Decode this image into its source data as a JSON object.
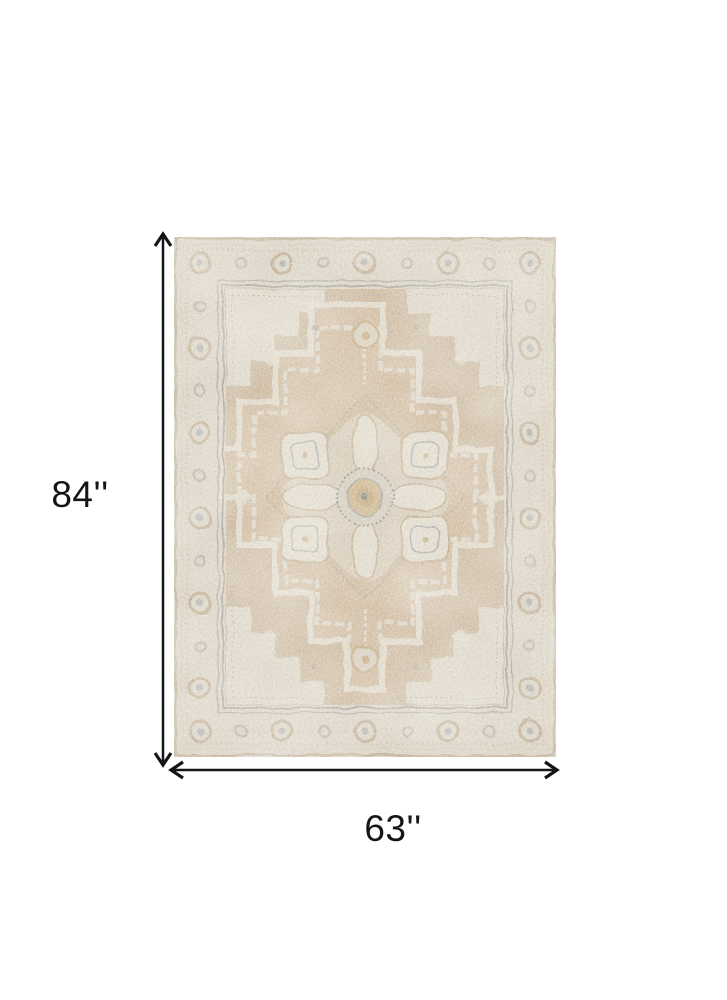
{
  "page": {
    "background_color": "#ffffff",
    "type": "product-dimension-diagram"
  },
  "product": {
    "description": "Distressed beige and tan traditional oriental area rug with large center medallion, ornate floral border and cream corner spandrels",
    "colors": {
      "border_band": "#d8d0c1",
      "field": "#c3a988",
      "medallion": "#c9ad8a",
      "motif_cream": "#e2dbcb",
      "spandrel": "#dcd5c5",
      "accent_gray": "#8d9295",
      "accent_gold": "#bb9a66",
      "frame_gray": "#93928b",
      "edge_tan": "#b5a084"
    }
  },
  "annotations": {
    "height_label": "84''",
    "width_label": "63''",
    "arrow_color": "#151515"
  }
}
